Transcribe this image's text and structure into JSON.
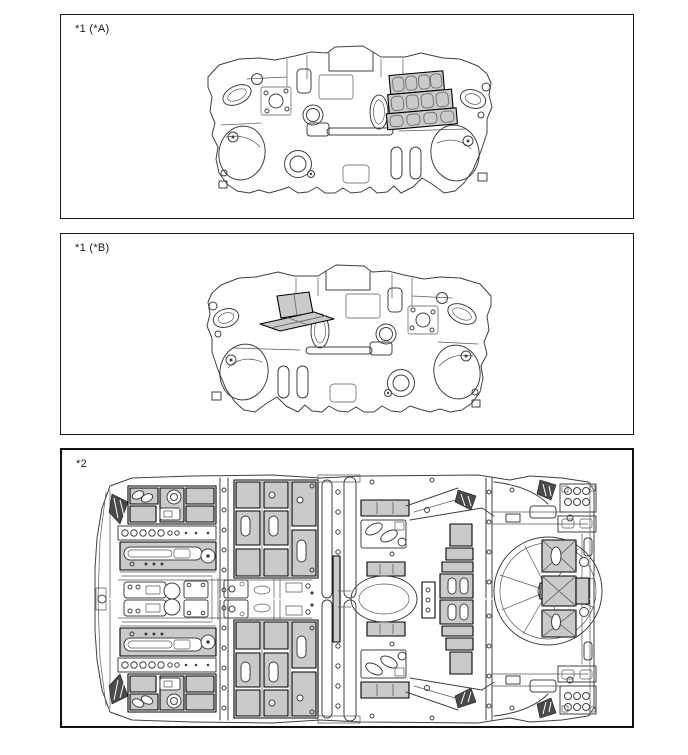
{
  "panels": [
    {
      "label": "*1 (*A)"
    },
    {
      "label": "*1 (*B)"
    },
    {
      "label": "*2"
    }
  ],
  "colors": {
    "background": "#ffffff",
    "line": "#404040",
    "pad_fill": "#cacaca",
    "pad_border": "#000000",
    "panel_border": "#1a1a1a"
  }
}
